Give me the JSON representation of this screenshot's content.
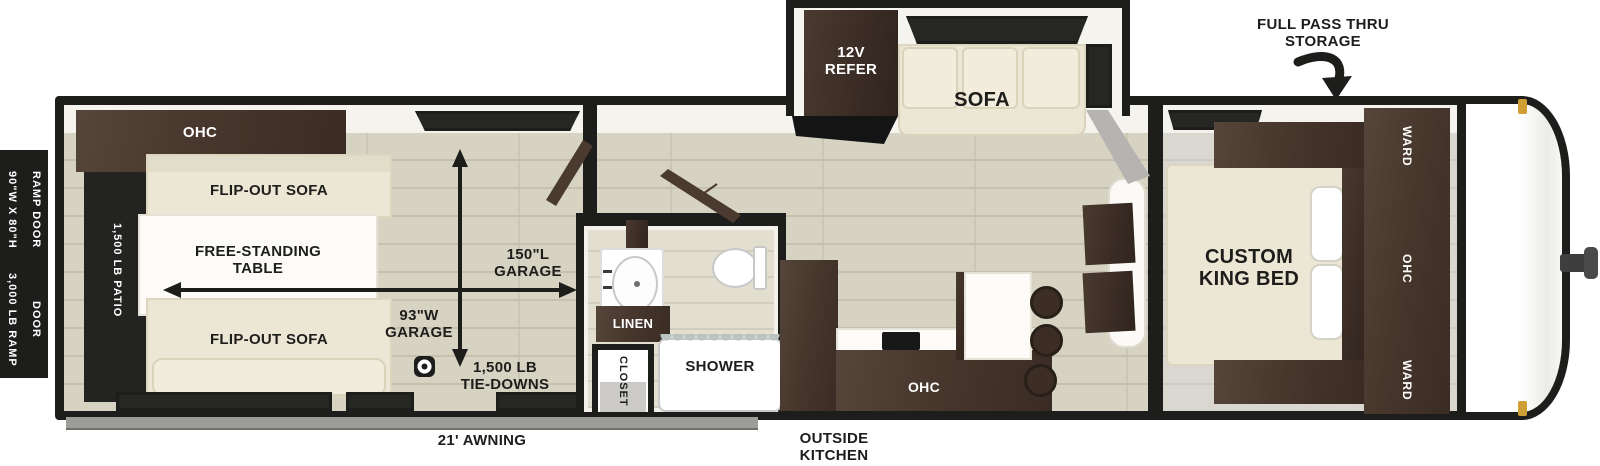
{
  "title": "toy hauler travel trailer floorplan",
  "colors": {
    "wall": "#1d1d1b",
    "wood_floor": "#d7d3c2",
    "cabinet_brown": "#46362c",
    "sofa_cream": "#ece7d4",
    "marker_light_amber": "#cf9f35",
    "awning_gray": "#9c9c98"
  },
  "exterior": {
    "ramp_door_size": {
      "line1": "90\"W X 80\"H",
      "line2": "RAMP DOOR"
    },
    "ramp_door_weight": {
      "line1": "3,000 LB RAMP",
      "line2": "DOOR"
    },
    "awning": "21' AWNING",
    "outside_kitchen": {
      "line1": "OUTSIDE",
      "line2": "KITCHEN"
    },
    "pass_thru": {
      "line1": "FULL PASS THRU",
      "line2": "STORAGE"
    }
  },
  "garage": {
    "patio": "1,500 LB PATIO",
    "ohc": "OHC",
    "flip_sofa_top": "FLIP-OUT SOFA",
    "flip_sofa_bottom": "FLIP-OUT SOFA",
    "table": {
      "line1": "FREE-STANDING",
      "line2": "TABLE"
    },
    "length": {
      "line1": "150\"L",
      "line2": "GARAGE"
    },
    "width": {
      "line1": "93\"W",
      "line2": "GARAGE"
    },
    "tie_downs": {
      "line1": "1,500 LB",
      "line2": "TIE-DOWNS"
    }
  },
  "bathroom": {
    "linen": "LINEN",
    "closet": "CLOSET",
    "shower": "SHOWER"
  },
  "living": {
    "refer": {
      "line1": "12V",
      "line2": "REFER"
    },
    "sofa": "SOFA",
    "kitchen_ohc": "OHC"
  },
  "bedroom": {
    "bed": {
      "line1": "CUSTOM",
      "line2": "KING BED"
    },
    "ward_top": "WARD",
    "ohc": "OHC",
    "ward_bottom": "WARD"
  }
}
